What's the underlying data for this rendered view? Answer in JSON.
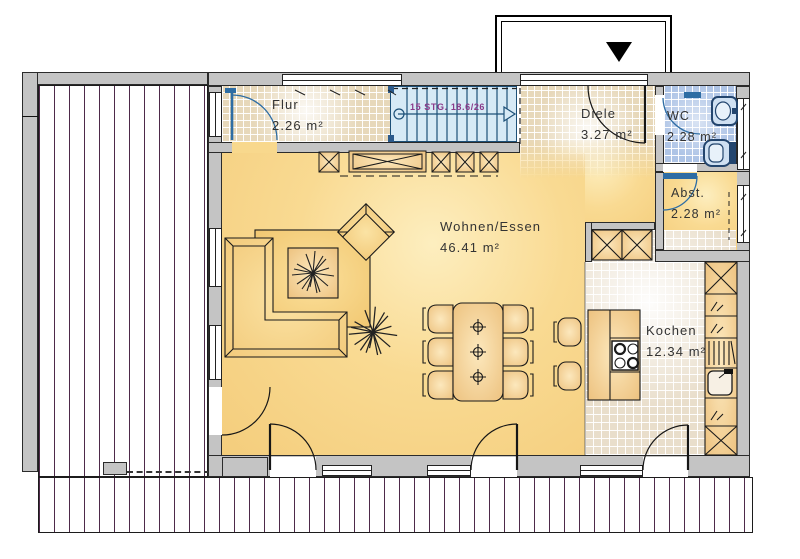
{
  "plan": {
    "rooms": {
      "flur": {
        "name": "Flur",
        "area": "2.26 m²"
      },
      "diele": {
        "name": "Diele",
        "area": "3.27 m²"
      },
      "wc": {
        "name": "WC",
        "area": "2.28 m²"
      },
      "abstellraum": {
        "name": "Abst.",
        "area": "2.28 m²"
      },
      "wohnen_essen": {
        "name": "Wohnen/Essen",
        "area": "46.41 m²"
      },
      "kochen": {
        "name": "Kochen",
        "area": "12.34 m²"
      }
    },
    "staircase": {
      "label": "15 STG. 18.6/26"
    },
    "icons": {
      "entrance_marker": "black triangle pointing down"
    },
    "colors": {
      "wall": "#c4c4c4",
      "floor_yellow": "#f8d78a",
      "tile_beige": "#e7d8ba",
      "tile_blue": "#aec4e6",
      "tile_kitchen": "#e9decb",
      "stair_fill": "#d7eaf6",
      "stair_line": "#1d5078",
      "stair_text": "#8a3a8a",
      "deck_board_line": "#4e2a4a",
      "door_blue": "#2e6da4",
      "cabinet": "#eec27f"
    }
  }
}
